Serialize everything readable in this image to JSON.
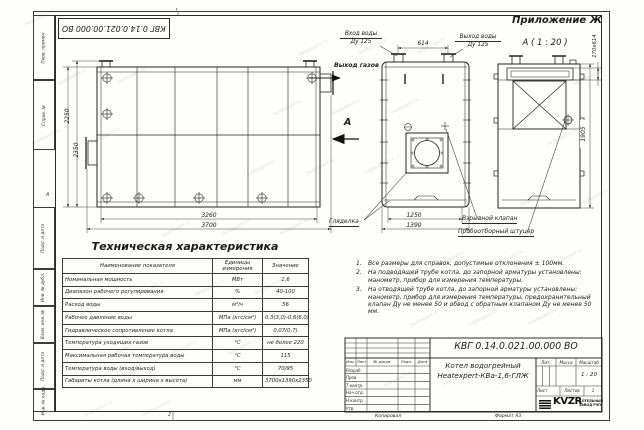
{
  "sheet": {
    "appendix": "Приложение Ж",
    "section_title": "А ( 1 : 20 )",
    "zone_top": "1",
    "zone_bottom": "2",
    "stamp_doc_number": "КВГ 0.14.0.021.00.000 ВО",
    "watermark_text": "heatexpert.ru"
  },
  "margin": {
    "cells": [
      "Перв. примен.",
      "Справ. №",
      "Подп. и дата",
      "Инв. № дубл.",
      "Взам. инв. №",
      "Подп. и дата",
      "Инв. № подл."
    ],
    "zone_letter": "А"
  },
  "views": {
    "side": {
      "dim_height_outer": "2250",
      "dim_height_inner": "2350",
      "dim_width_inner": "3260",
      "dim_width_outer": "3700"
    },
    "front": {
      "label_inlet_line1": "Вход воды",
      "label_inlet_line2": "Ду 125",
      "label_outlet_line1": "Выход воды",
      "label_outlet_line2": "Ду 125",
      "dim_flange_spacing": "614",
      "label_gas_outlet": "Выход газов",
      "section_arrow_letter": "А",
      "dim_width_inner": "1250",
      "dim_width_outer": "1390",
      "label_sight_glass": "Гляделка",
      "label_explosion_valve": "Взрывной клапан",
      "label_sampling_nozzle": "Пробоотборный штуцер"
    },
    "rear": {
      "dim_height": "1905",
      "dim_flue": "170х614"
    }
  },
  "table": {
    "title": "Техническая характеристика",
    "headers": [
      "Наименование показателя",
      "Единицы измерения",
      "Значение"
    ],
    "rows": [
      [
        "Номинальная мощность",
        "МВт",
        "1,6"
      ],
      [
        "Диапазон рабочего регулирования",
        "%",
        "40-100"
      ],
      [
        "Расход воды",
        "м³/ч",
        "56"
      ],
      [
        "Рабочее давление воды",
        "МПа (кгс/см²)",
        "0,3(3,0)-0,6(6,0)"
      ],
      [
        "Гидравлическое сопротивление котла",
        "МПа (кгс/см²)",
        "0,07(0,7)"
      ],
      [
        "Температура уходящих газов",
        "°С",
        "не более 220"
      ],
      [
        "Максимальная рабочая температура воды",
        "°С",
        "115"
      ],
      [
        "Температура воды (вход/выход)",
        "°С",
        "70/95"
      ],
      [
        "Габариты котла (длина х ширина х высота)",
        "мм",
        "3700х1390х2350"
      ]
    ]
  },
  "notes": [
    {
      "num": "1.",
      "text": "Все размеры для справок, допустимые отклонения ± 100мм."
    },
    {
      "num": "2.",
      "text": "На подводящей трубе котла, до запорной арматуры установлены: манометр, прибор для измерения температуры."
    },
    {
      "num": "3.",
      "text": "На отводящей трубе котла, до запорной арматуры установлены: манометр, прибор для измерения температуры, предохранительный клапан Ду не менее 50 и обвод с обратным клапаном Ду не менее 50 мм."
    }
  ],
  "title_block": {
    "doc_number": "КВГ 0.14.0.021.00.000 ВО",
    "name_line1": "Котел водогрейный",
    "name_line2": "Heatexpert-КВа-1,6-ГЛЖ",
    "header_cells": [
      "Изм.",
      "Лист",
      "№ докум.",
      "Подп.",
      "Дата"
    ],
    "rows": [
      "Разраб.",
      "Пров.",
      "Т.контр.",
      "Нач.отд.",
      "Н.контр.",
      "Утв."
    ],
    "lit_label": "Лит.",
    "mass_label": "Масса",
    "scale_label": "Масштаб",
    "scale_value": "1 : 20",
    "sheet_label": "Лист",
    "sheets_label": "Листов",
    "sheets_value": "1",
    "logo_text": "KVZR",
    "company_line1": "КОТЕЛЬНЫЙ",
    "company_line2": "ЗАВОД РЭП",
    "footer_copy": "Копировал",
    "footer_format": "Формат А3"
  }
}
